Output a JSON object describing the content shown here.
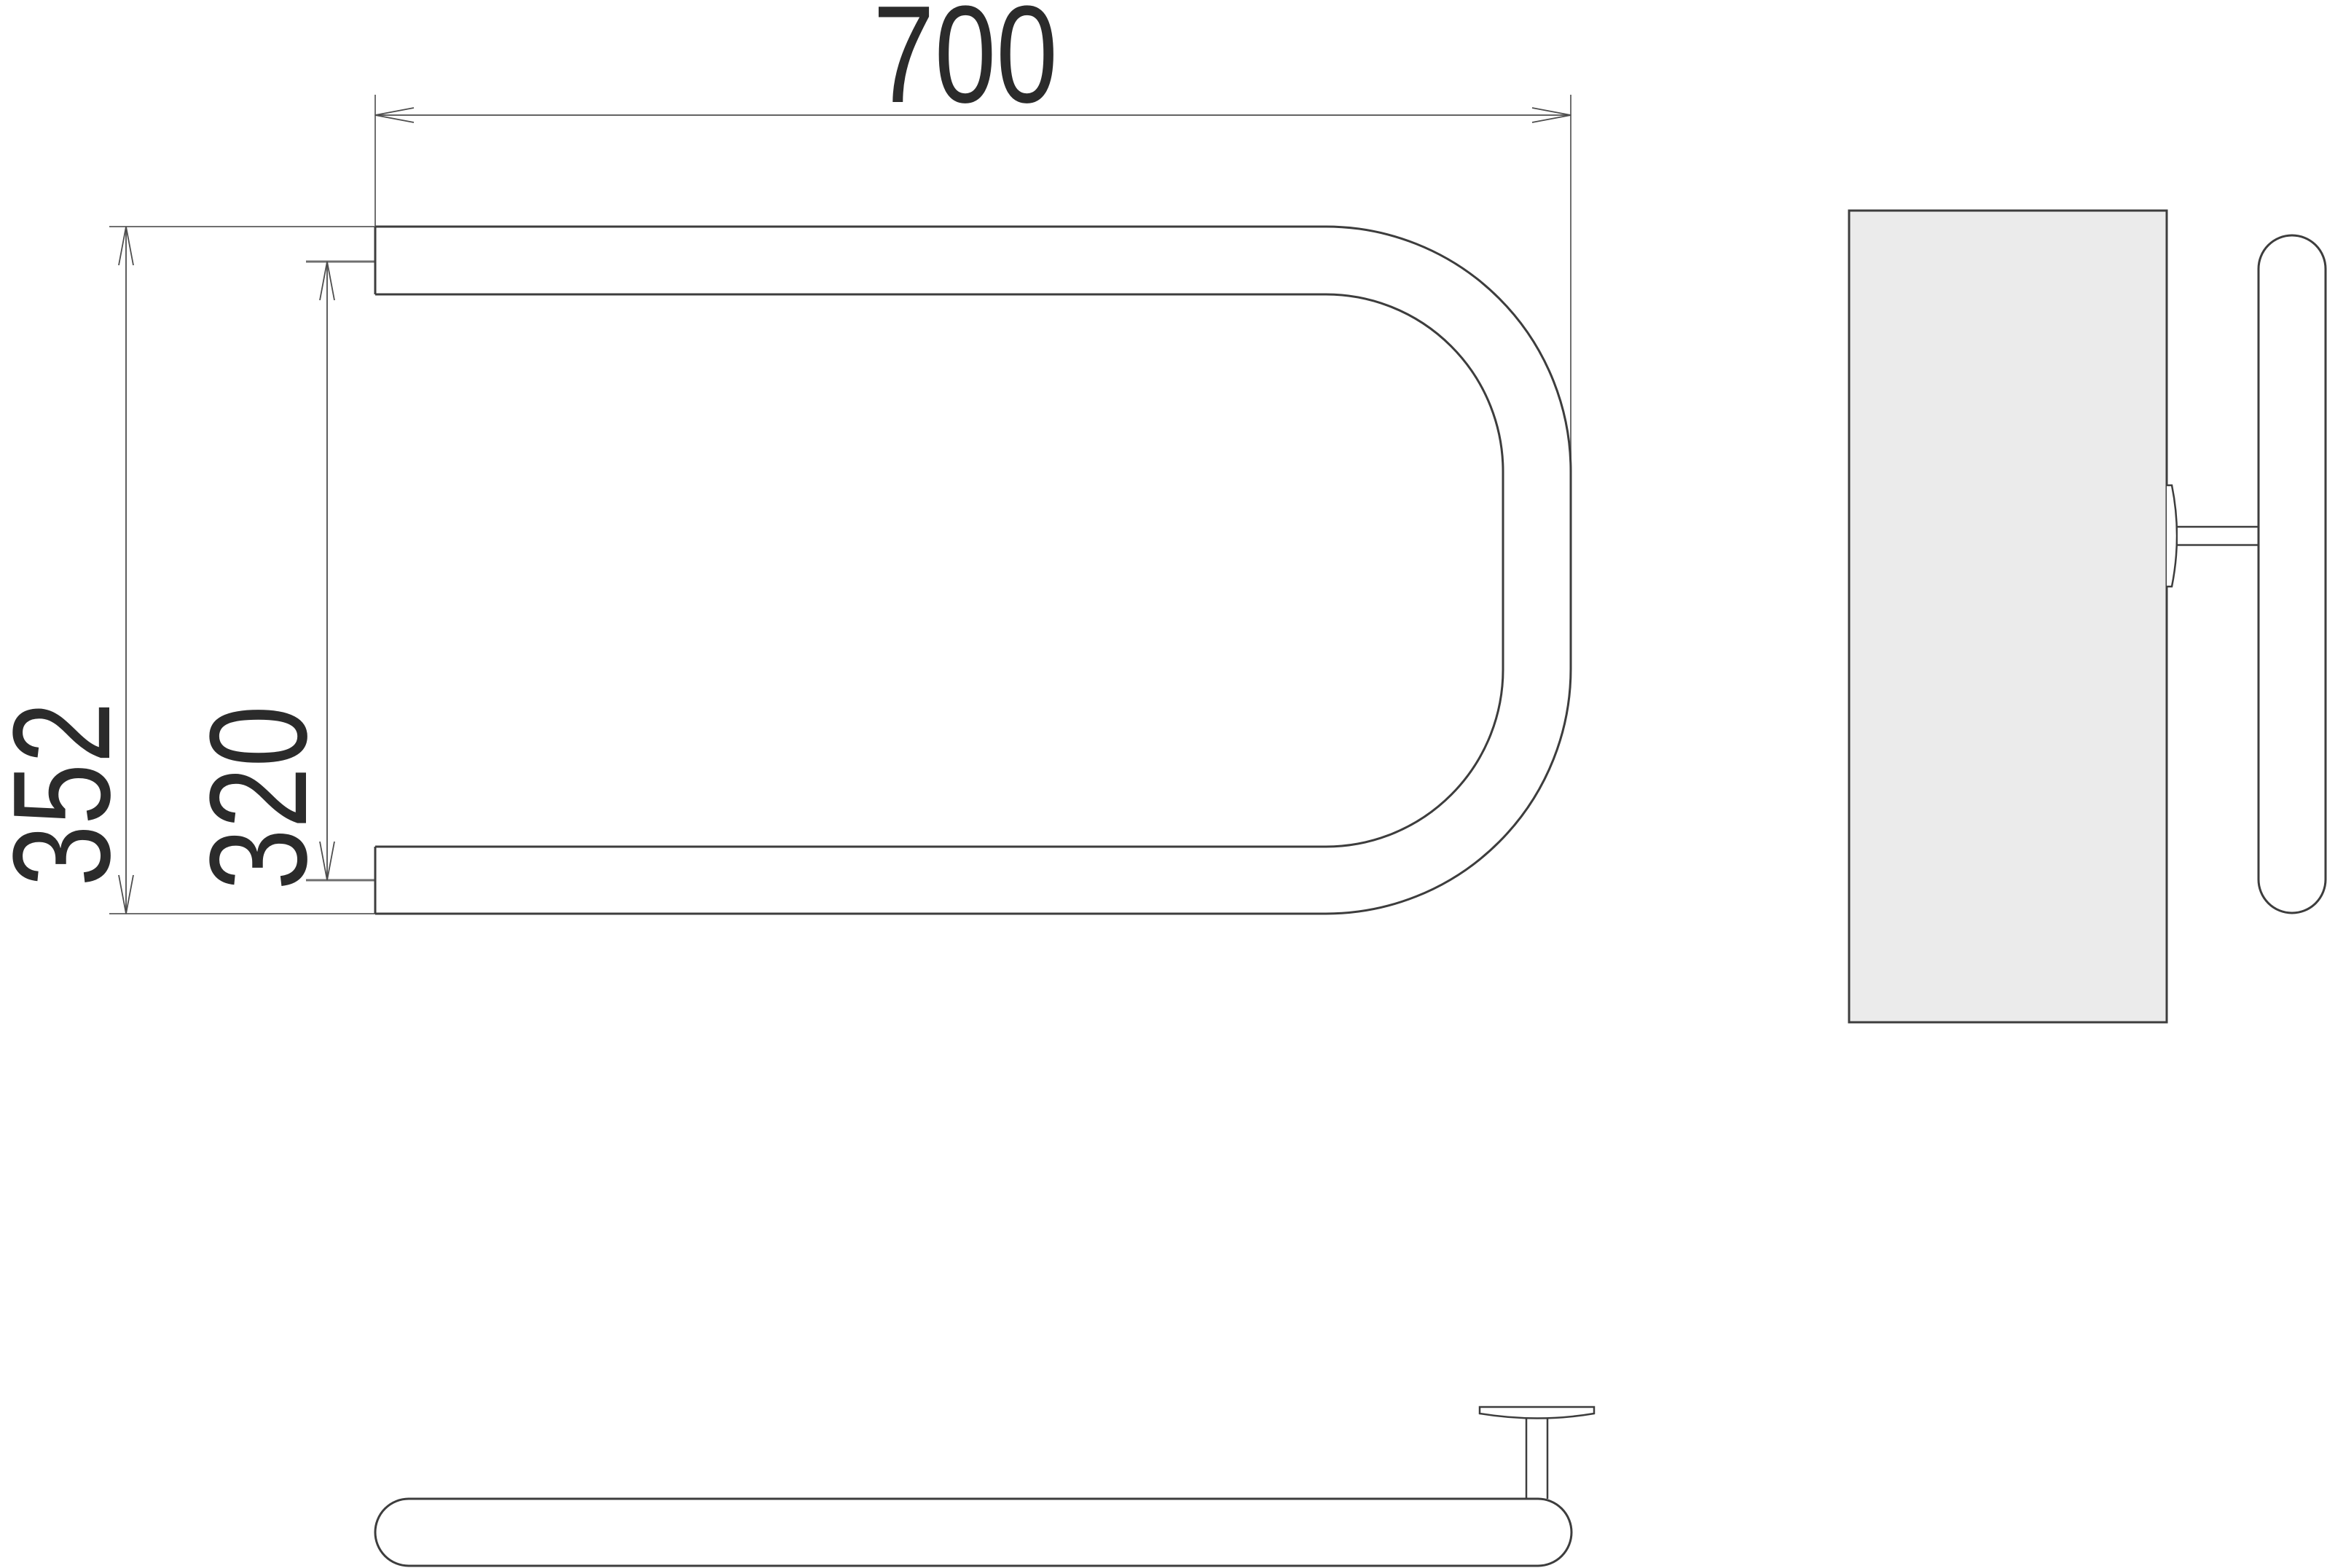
{
  "drawing": {
    "type": "technical-drawing",
    "views": {
      "front_view": "U-shaped towel rail tube, opening left",
      "side_view": "wall plate with bracket, stem and tube seen end-on",
      "bottom_view": "tube seen from below with mounting stem and wall flange"
    },
    "dimensions": {
      "width_label": "700",
      "outer_height_label": "352",
      "inner_height_label": "320"
    },
    "colors": {
      "object_line": "#3d3d3d",
      "dimension_line": "#4d4d4d",
      "extension_line": "#6f6f6f",
      "plate_fill": "#ebebeb",
      "text": "#2b2b2b",
      "background": "#ffffff"
    }
  }
}
